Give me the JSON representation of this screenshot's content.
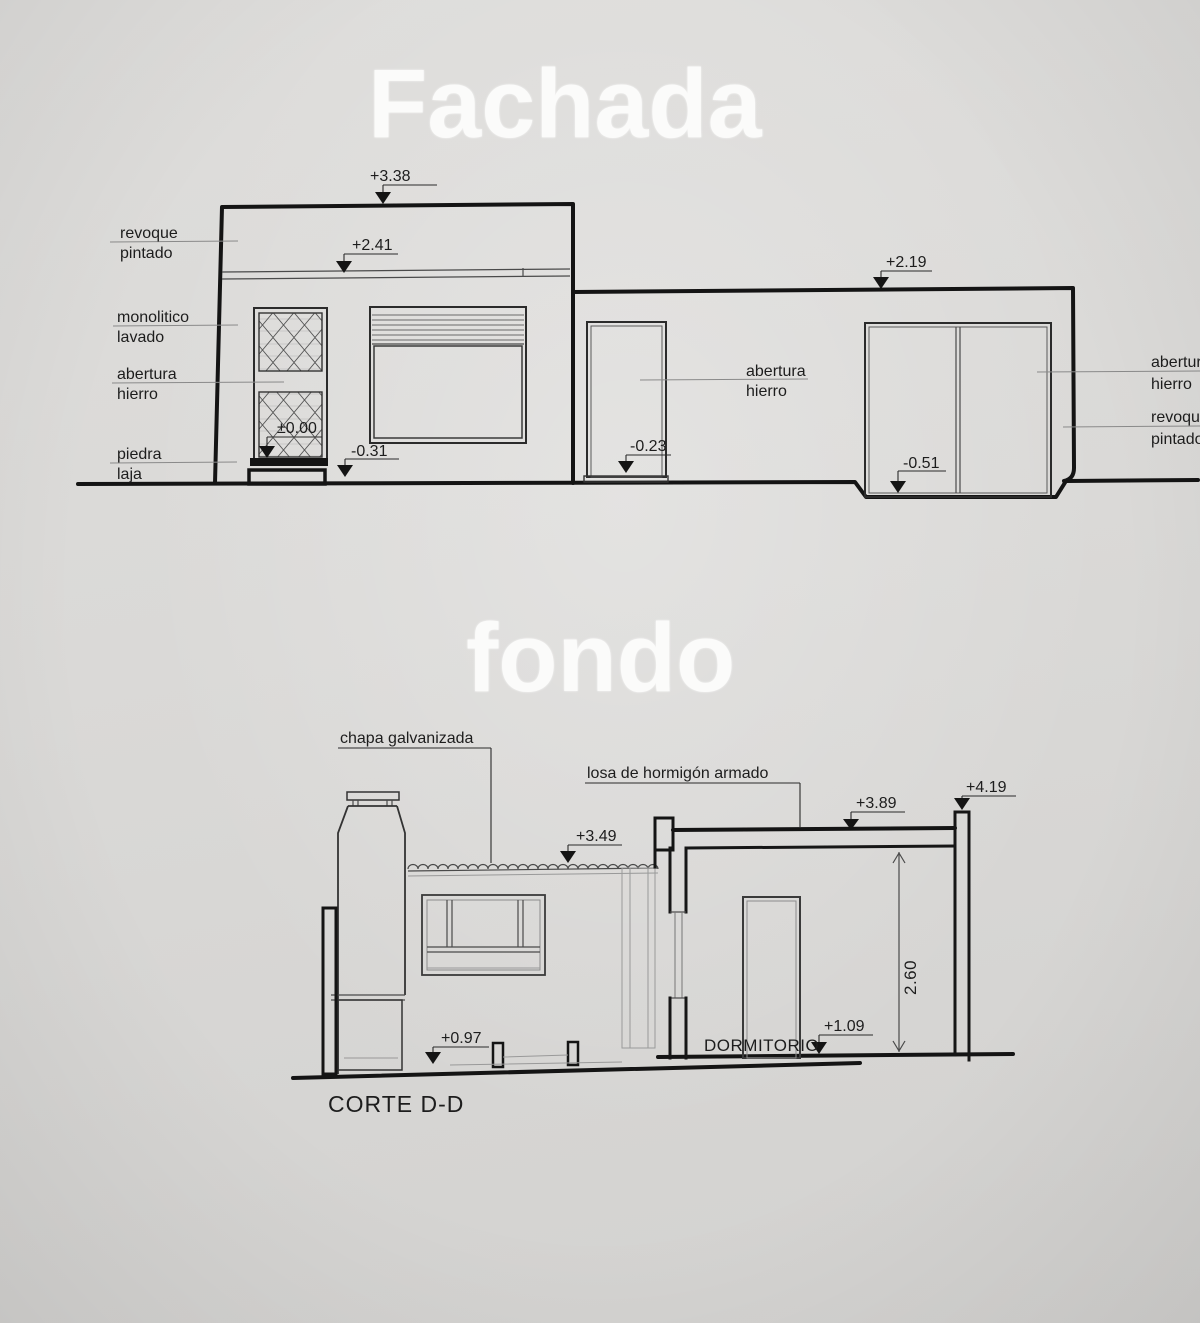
{
  "titles": {
    "facade": "Fachada",
    "section": "fondo"
  },
  "facade": {
    "markers": {
      "roof": "+3.38",
      "band": "+2.41",
      "right_top": "+2.19",
      "zero": "±0.00",
      "ground_left": "-0.31",
      "ground_door": "-0.23",
      "ground_right": "-0.51"
    },
    "labels": {
      "revoque": {
        "l1": "revoque",
        "l2": "pintado"
      },
      "monolitico": {
        "l1": "monolitico",
        "l2": "lavado"
      },
      "abertura": {
        "l1": "abertura",
        "l2": "hierro"
      },
      "piedra": {
        "l1": "piedra",
        "l2": "laja"
      },
      "abertura_center": {
        "l1": "abertura",
        "l2": "hierro"
      },
      "abertura_right": {
        "l1": "abertura",
        "l2": "hierro"
      },
      "revoque_right": {
        "l1": "revoque",
        "l2": "pintado"
      }
    }
  },
  "section": {
    "markers": {
      "roof_sheet": "+3.49",
      "slab": "+3.89",
      "parapet": "+4.19",
      "floor_left": "+0.97",
      "floor_room": "+1.09"
    },
    "dimension_height": "2.60",
    "labels": {
      "chapa": "chapa galvanizada",
      "losa": "losa de hormigón armado",
      "room": "DORMITORIO",
      "caption": "CORTE D-D"
    }
  }
}
